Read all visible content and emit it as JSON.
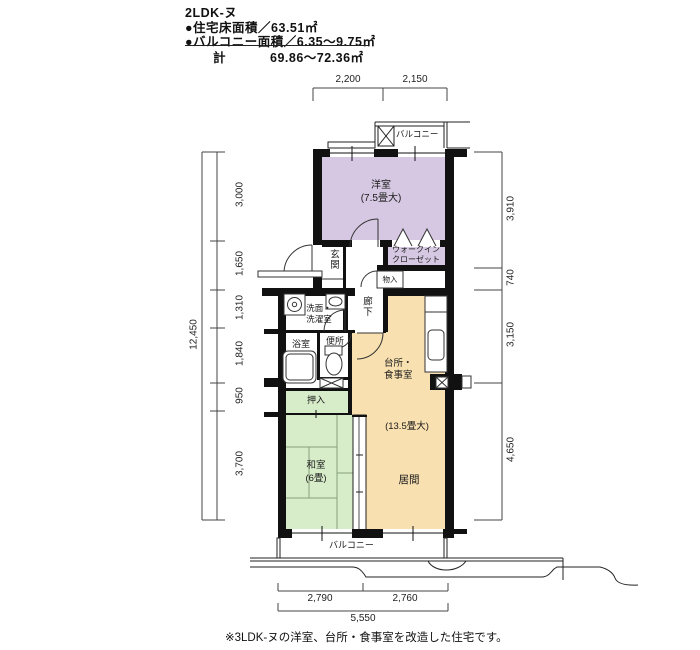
{
  "header": {
    "title": "2LDK-ヌ",
    "floor_area_line": "●住宅床面積／63.51㎡",
    "balcony_area_line": "●バルコニー面積／6.35〜9.75㎡",
    "total_label": "計",
    "total_value": "69.86〜72.36㎡"
  },
  "rooms": {
    "western": {
      "name": "洋室",
      "size": "(7.5畳大)"
    },
    "walkin_1": "ウォークイン",
    "walkin_2": "クローゼット",
    "genkan": "玄関",
    "mononoire": "物入",
    "rouka": "廊下",
    "senmen_1": "洗面・",
    "senmen_2": "洗濯室",
    "yokushitsu": "浴室",
    "benjo": "便所",
    "daidokoro_1": "台所・",
    "daidokoro_2": "食事室",
    "ldk_size": "(13.5畳大)",
    "ima": "居間",
    "oshiire": "押入",
    "washitsu": "和室",
    "washitsu_size": "(6畳)",
    "balcony_top": "バルコニー",
    "balcony_bottom": "バルコニー"
  },
  "dimensions": {
    "top": [
      "2,200",
      "2,150"
    ],
    "left_total": "12,450",
    "left": [
      "3,000",
      "1,650",
      "1,310",
      "1,840",
      "950",
      "3,700"
    ],
    "right": [
      "3,910",
      "740",
      "3,150",
      "4,650"
    ],
    "bottom": [
      "2,790",
      "2,760"
    ],
    "bottom_total": "5,550"
  },
  "footer": {
    "note": "※3LDK-ヌの洋室、台所・食事室を改造した住宅です。"
  },
  "colors": {
    "western_room": "#d6c8e2",
    "ldk": "#f8e0b0",
    "tatami": "#d7ecc9",
    "wall": "#111111"
  }
}
